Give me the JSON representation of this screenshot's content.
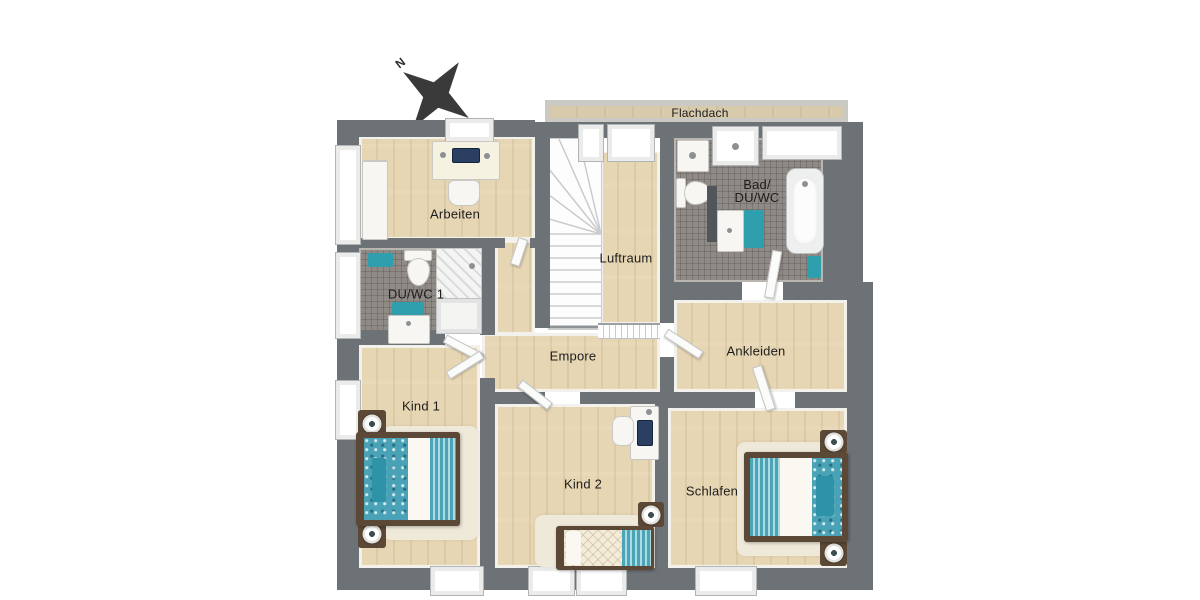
{
  "compass": {
    "north_label": "N"
  },
  "rooms": {
    "flachdach": {
      "label": "Flachdach"
    },
    "arbeiten": {
      "label": "Arbeiten"
    },
    "bad": {
      "label_line1": "Bad/",
      "label_line2": "DU/WC"
    },
    "luftraum": {
      "label": "Luftraum"
    },
    "duwc1": {
      "label": "DU/WC 1"
    },
    "empore": {
      "label": "Empore"
    },
    "ankleiden": {
      "label": "Ankleiden"
    },
    "kind1": {
      "label": "Kind 1"
    },
    "kind2": {
      "label": "Kind 2"
    },
    "schlafen": {
      "label": "Schlafen"
    }
  },
  "colors": {
    "wall": "#6d7276",
    "wood_floor": "#e7d6b4",
    "tile_floor": "#8f8a86",
    "accent_teal": "#2f9fae",
    "bed_frame_brown": "#5c4836",
    "flat_roof_grey": "#cbc9c3",
    "flat_roof_tan": "#d9cba9",
    "compass_dark": "#3a3a3a"
  }
}
